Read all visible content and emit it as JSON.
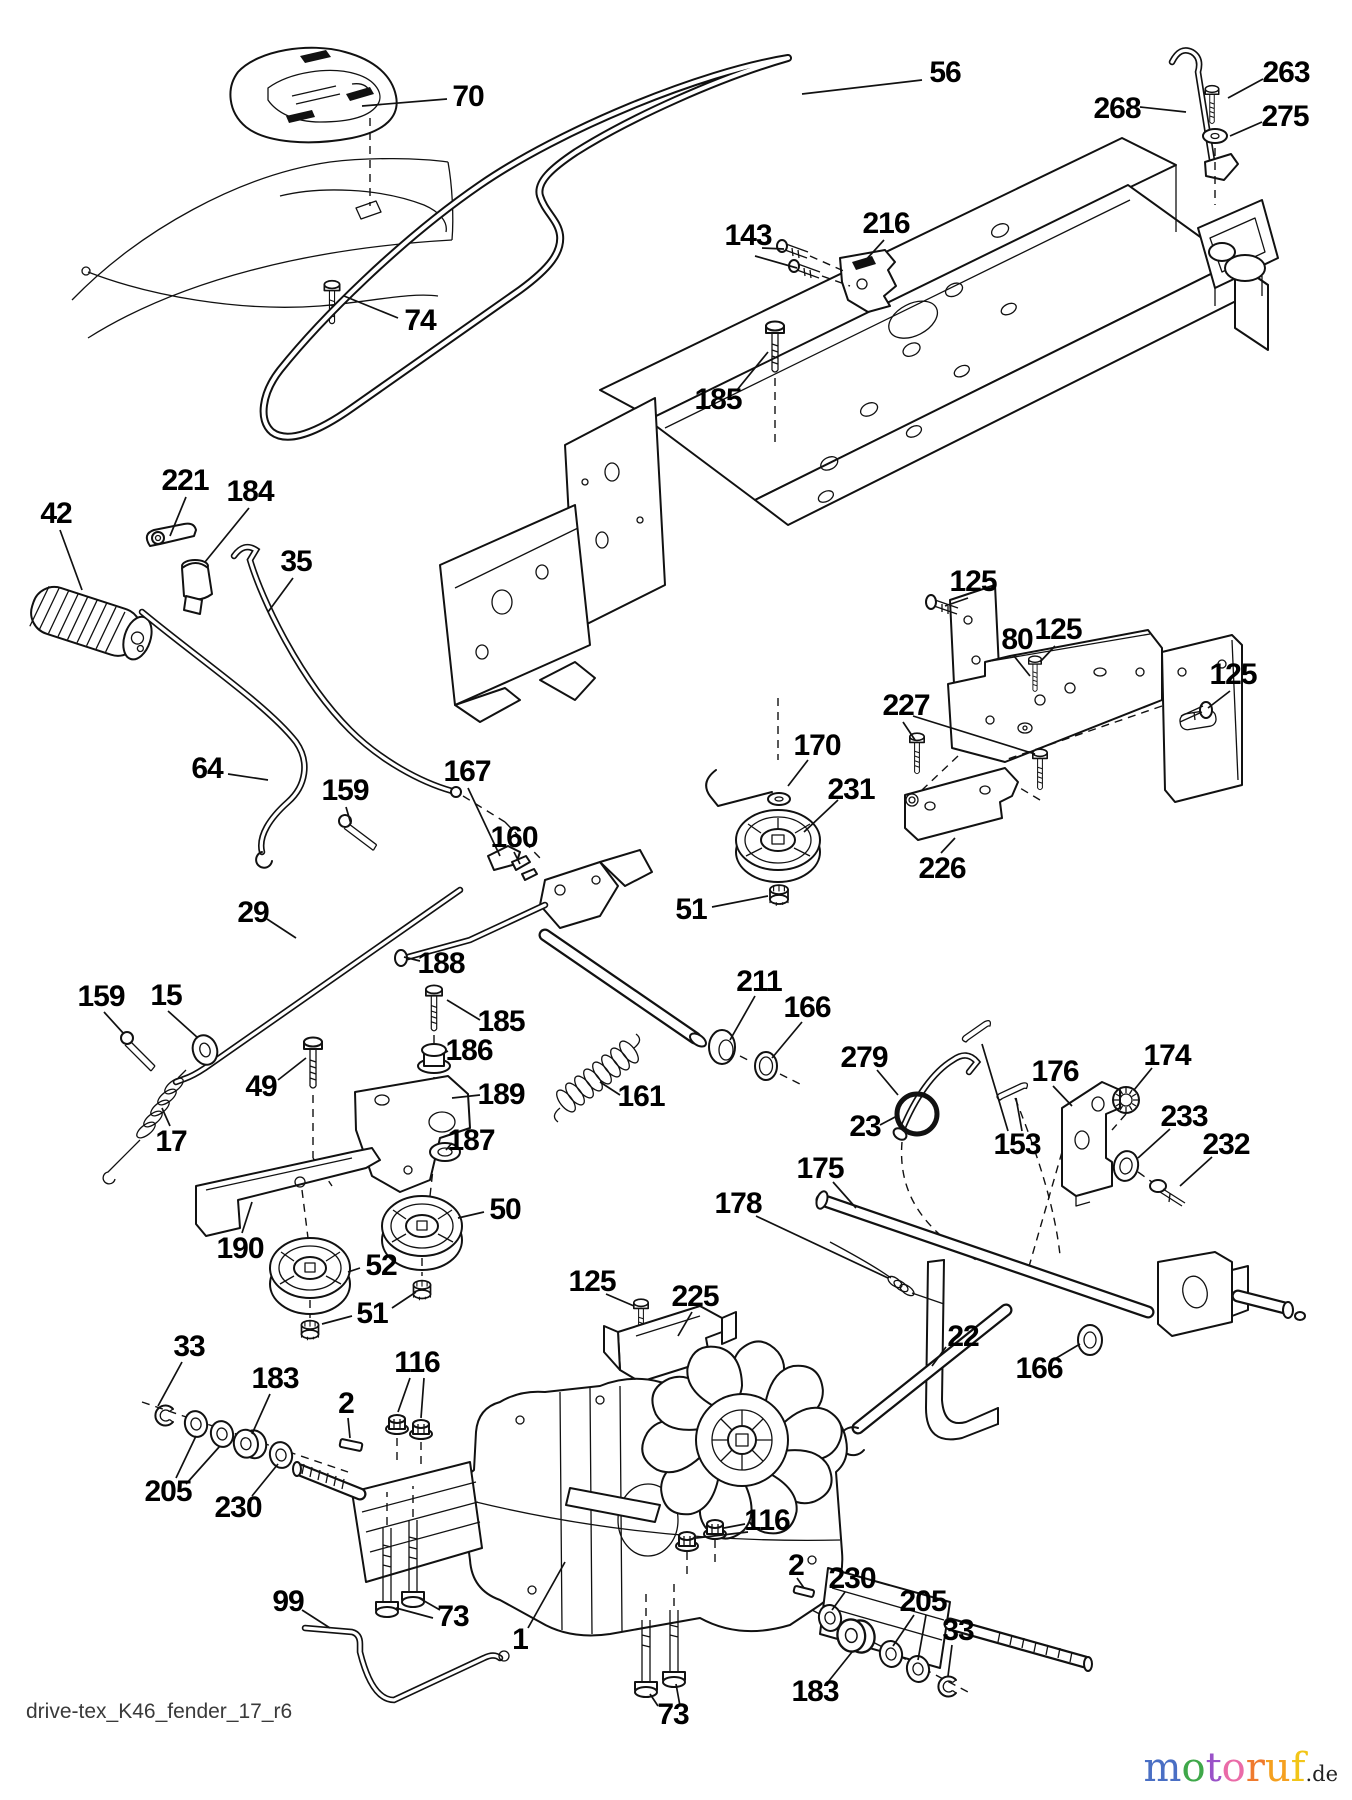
{
  "page": {
    "background": "#ffffff",
    "line_color": "#111111"
  },
  "diagram": {
    "footer_code": "drive-tex_K46_fender_17_r6",
    "labels": [
      {
        "t": "70",
        "x": 468,
        "y": 97
      },
      {
        "t": "56",
        "x": 945,
        "y": 73
      },
      {
        "t": "263",
        "x": 1286,
        "y": 73
      },
      {
        "t": "268",
        "x": 1117,
        "y": 109
      },
      {
        "t": "275",
        "x": 1285,
        "y": 117
      },
      {
        "t": "143",
        "x": 748,
        "y": 236
      },
      {
        "t": "216",
        "x": 886,
        "y": 224
      },
      {
        "t": "74",
        "x": 420,
        "y": 321
      },
      {
        "t": "185",
        "x": 718,
        "y": 400
      },
      {
        "t": "221",
        "x": 185,
        "y": 481
      },
      {
        "t": "184",
        "x": 250,
        "y": 492
      },
      {
        "t": "42",
        "x": 56,
        "y": 514
      },
      {
        "t": "35",
        "x": 296,
        "y": 562
      },
      {
        "t": "125",
        "x": 973,
        "y": 582
      },
      {
        "t": "80",
        "x": 1017,
        "y": 640
      },
      {
        "t": "125",
        "x": 1058,
        "y": 630
      },
      {
        "t": "125",
        "x": 1233,
        "y": 675
      },
      {
        "t": "227",
        "x": 906,
        "y": 706
      },
      {
        "t": "64",
        "x": 207,
        "y": 769
      },
      {
        "t": "159",
        "x": 345,
        "y": 791
      },
      {
        "t": "167",
        "x": 467,
        "y": 772
      },
      {
        "t": "170",
        "x": 817,
        "y": 746
      },
      {
        "t": "231",
        "x": 851,
        "y": 790
      },
      {
        "t": "160",
        "x": 514,
        "y": 838
      },
      {
        "t": "226",
        "x": 942,
        "y": 869
      },
      {
        "t": "29",
        "x": 253,
        "y": 913
      },
      {
        "t": "51",
        "x": 691,
        "y": 910
      },
      {
        "t": "188",
        "x": 441,
        "y": 964
      },
      {
        "t": "211",
        "x": 759,
        "y": 982
      },
      {
        "t": "166",
        "x": 807,
        "y": 1008
      },
      {
        "t": "159",
        "x": 101,
        "y": 997
      },
      {
        "t": "15",
        "x": 166,
        "y": 996
      },
      {
        "t": "185",
        "x": 501,
        "y": 1022
      },
      {
        "t": "186",
        "x": 469,
        "y": 1051
      },
      {
        "t": "279",
        "x": 864,
        "y": 1058
      },
      {
        "t": "176",
        "x": 1055,
        "y": 1072
      },
      {
        "t": "174",
        "x": 1167,
        "y": 1056
      },
      {
        "t": "49",
        "x": 261,
        "y": 1087
      },
      {
        "t": "189",
        "x": 501,
        "y": 1095
      },
      {
        "t": "161",
        "x": 641,
        "y": 1097
      },
      {
        "t": "23",
        "x": 865,
        "y": 1127
      },
      {
        "t": "153",
        "x": 1017,
        "y": 1145
      },
      {
        "t": "233",
        "x": 1184,
        "y": 1117
      },
      {
        "t": "232",
        "x": 1226,
        "y": 1145
      },
      {
        "t": "17",
        "x": 171,
        "y": 1142
      },
      {
        "t": "187",
        "x": 471,
        "y": 1141
      },
      {
        "t": "175",
        "x": 820,
        "y": 1169
      },
      {
        "t": "50",
        "x": 505,
        "y": 1210
      },
      {
        "t": "190",
        "x": 240,
        "y": 1249
      },
      {
        "t": "178",
        "x": 738,
        "y": 1204
      },
      {
        "t": "52",
        "x": 381,
        "y": 1266
      },
      {
        "t": "125",
        "x": 592,
        "y": 1282
      },
      {
        "t": "225",
        "x": 695,
        "y": 1297
      },
      {
        "t": "51",
        "x": 372,
        "y": 1314
      },
      {
        "t": "22",
        "x": 963,
        "y": 1337
      },
      {
        "t": "166",
        "x": 1039,
        "y": 1369
      },
      {
        "t": "33",
        "x": 189,
        "y": 1347
      },
      {
        "t": "183",
        "x": 275,
        "y": 1379
      },
      {
        "t": "116",
        "x": 417,
        "y": 1363
      },
      {
        "t": "2",
        "x": 346,
        "y": 1404
      },
      {
        "t": "205",
        "x": 168,
        "y": 1492
      },
      {
        "t": "230",
        "x": 238,
        "y": 1508
      },
      {
        "t": "116",
        "x": 767,
        "y": 1521
      },
      {
        "t": "2",
        "x": 796,
        "y": 1566
      },
      {
        "t": "230",
        "x": 852,
        "y": 1579
      },
      {
        "t": "205",
        "x": 923,
        "y": 1602
      },
      {
        "t": "33",
        "x": 958,
        "y": 1631
      },
      {
        "t": "99",
        "x": 288,
        "y": 1602
      },
      {
        "t": "73",
        "x": 453,
        "y": 1617
      },
      {
        "t": "1",
        "x": 520,
        "y": 1640
      },
      {
        "t": "183",
        "x": 815,
        "y": 1692
      },
      {
        "t": "73",
        "x": 673,
        "y": 1715
      }
    ]
  },
  "watermark": {
    "letters": [
      {
        "ch": "m",
        "color": "#4a6fc4"
      },
      {
        "ch": "o",
        "color": "#3fa84a"
      },
      {
        "ch": "t",
        "color": "#9a52c8"
      },
      {
        "ch": "o",
        "color": "#ea6ba8"
      },
      {
        "ch": "r",
        "color": "#ef7a2e"
      },
      {
        "ch": "u",
        "color": "#f5a01f"
      },
      {
        "ch": "f",
        "color": "#f2c518"
      }
    ],
    "suffix": ".de"
  }
}
